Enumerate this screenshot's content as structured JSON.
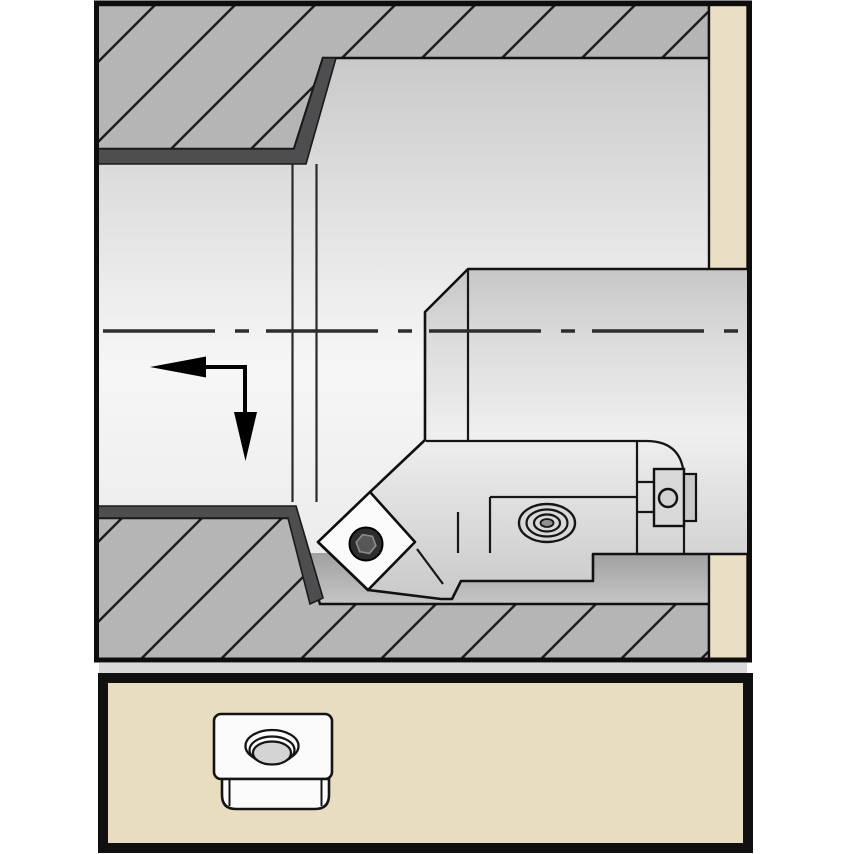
{
  "canvas": {
    "width": 854,
    "height": 854
  },
  "figure": {
    "subject": "Cross-section technical illustration of an indexable boring tool machining a stepped internal bore (counterbore), with feed-direction arrow and insert icon panel below",
    "upper_view": {
      "workpiece": "hatched cross-section with stepped bore",
      "fixture": "tan clamping strip at right",
      "tool": "boring bar shank with insert cartridge head",
      "insert": "diamond-shaped indexable insert with center screw",
      "clamp_screw": "oval socket clamp screw in cartridge pocket",
      "side_screw": "side locking screw on cartridge",
      "centerline": "horizontal dash-dot axis line",
      "feed_arrow": "feed direction arrow pointing left then down"
    },
    "lower_panel": {
      "item": "indexable insert icon with countersunk center hole"
    }
  },
  "colors": {
    "background": "#ffffff",
    "outline": "#111111",
    "hatch_fill": "#b5b5b6",
    "hatch_line": "#1b1b1b",
    "dark_band": "#4e4e50",
    "bore_top": "#c0c0c0",
    "bore_light": "#f6f6f6",
    "bore_bottom": "#e6e6e6",
    "tool_light": "#efefef",
    "tool_dark": "#c6c6c6",
    "wall_band_top": "#a0a0a0",
    "wall_band_bottom": "#c6c6c6",
    "fixture_tan": "#eadfc4",
    "panel_fill": "#e9ddc1",
    "panel_border": "#101010",
    "insert_fill": "#fbfbfb",
    "screw_dark": "#2e2e2e",
    "screw_hex": "#575757",
    "screw_hex_edge": "#8d8d8d",
    "metal_detail": "#d9d9d9",
    "gap_strip": "#d9d9d9",
    "centerline": "#2c2c2c",
    "arrow": "#000000"
  }
}
